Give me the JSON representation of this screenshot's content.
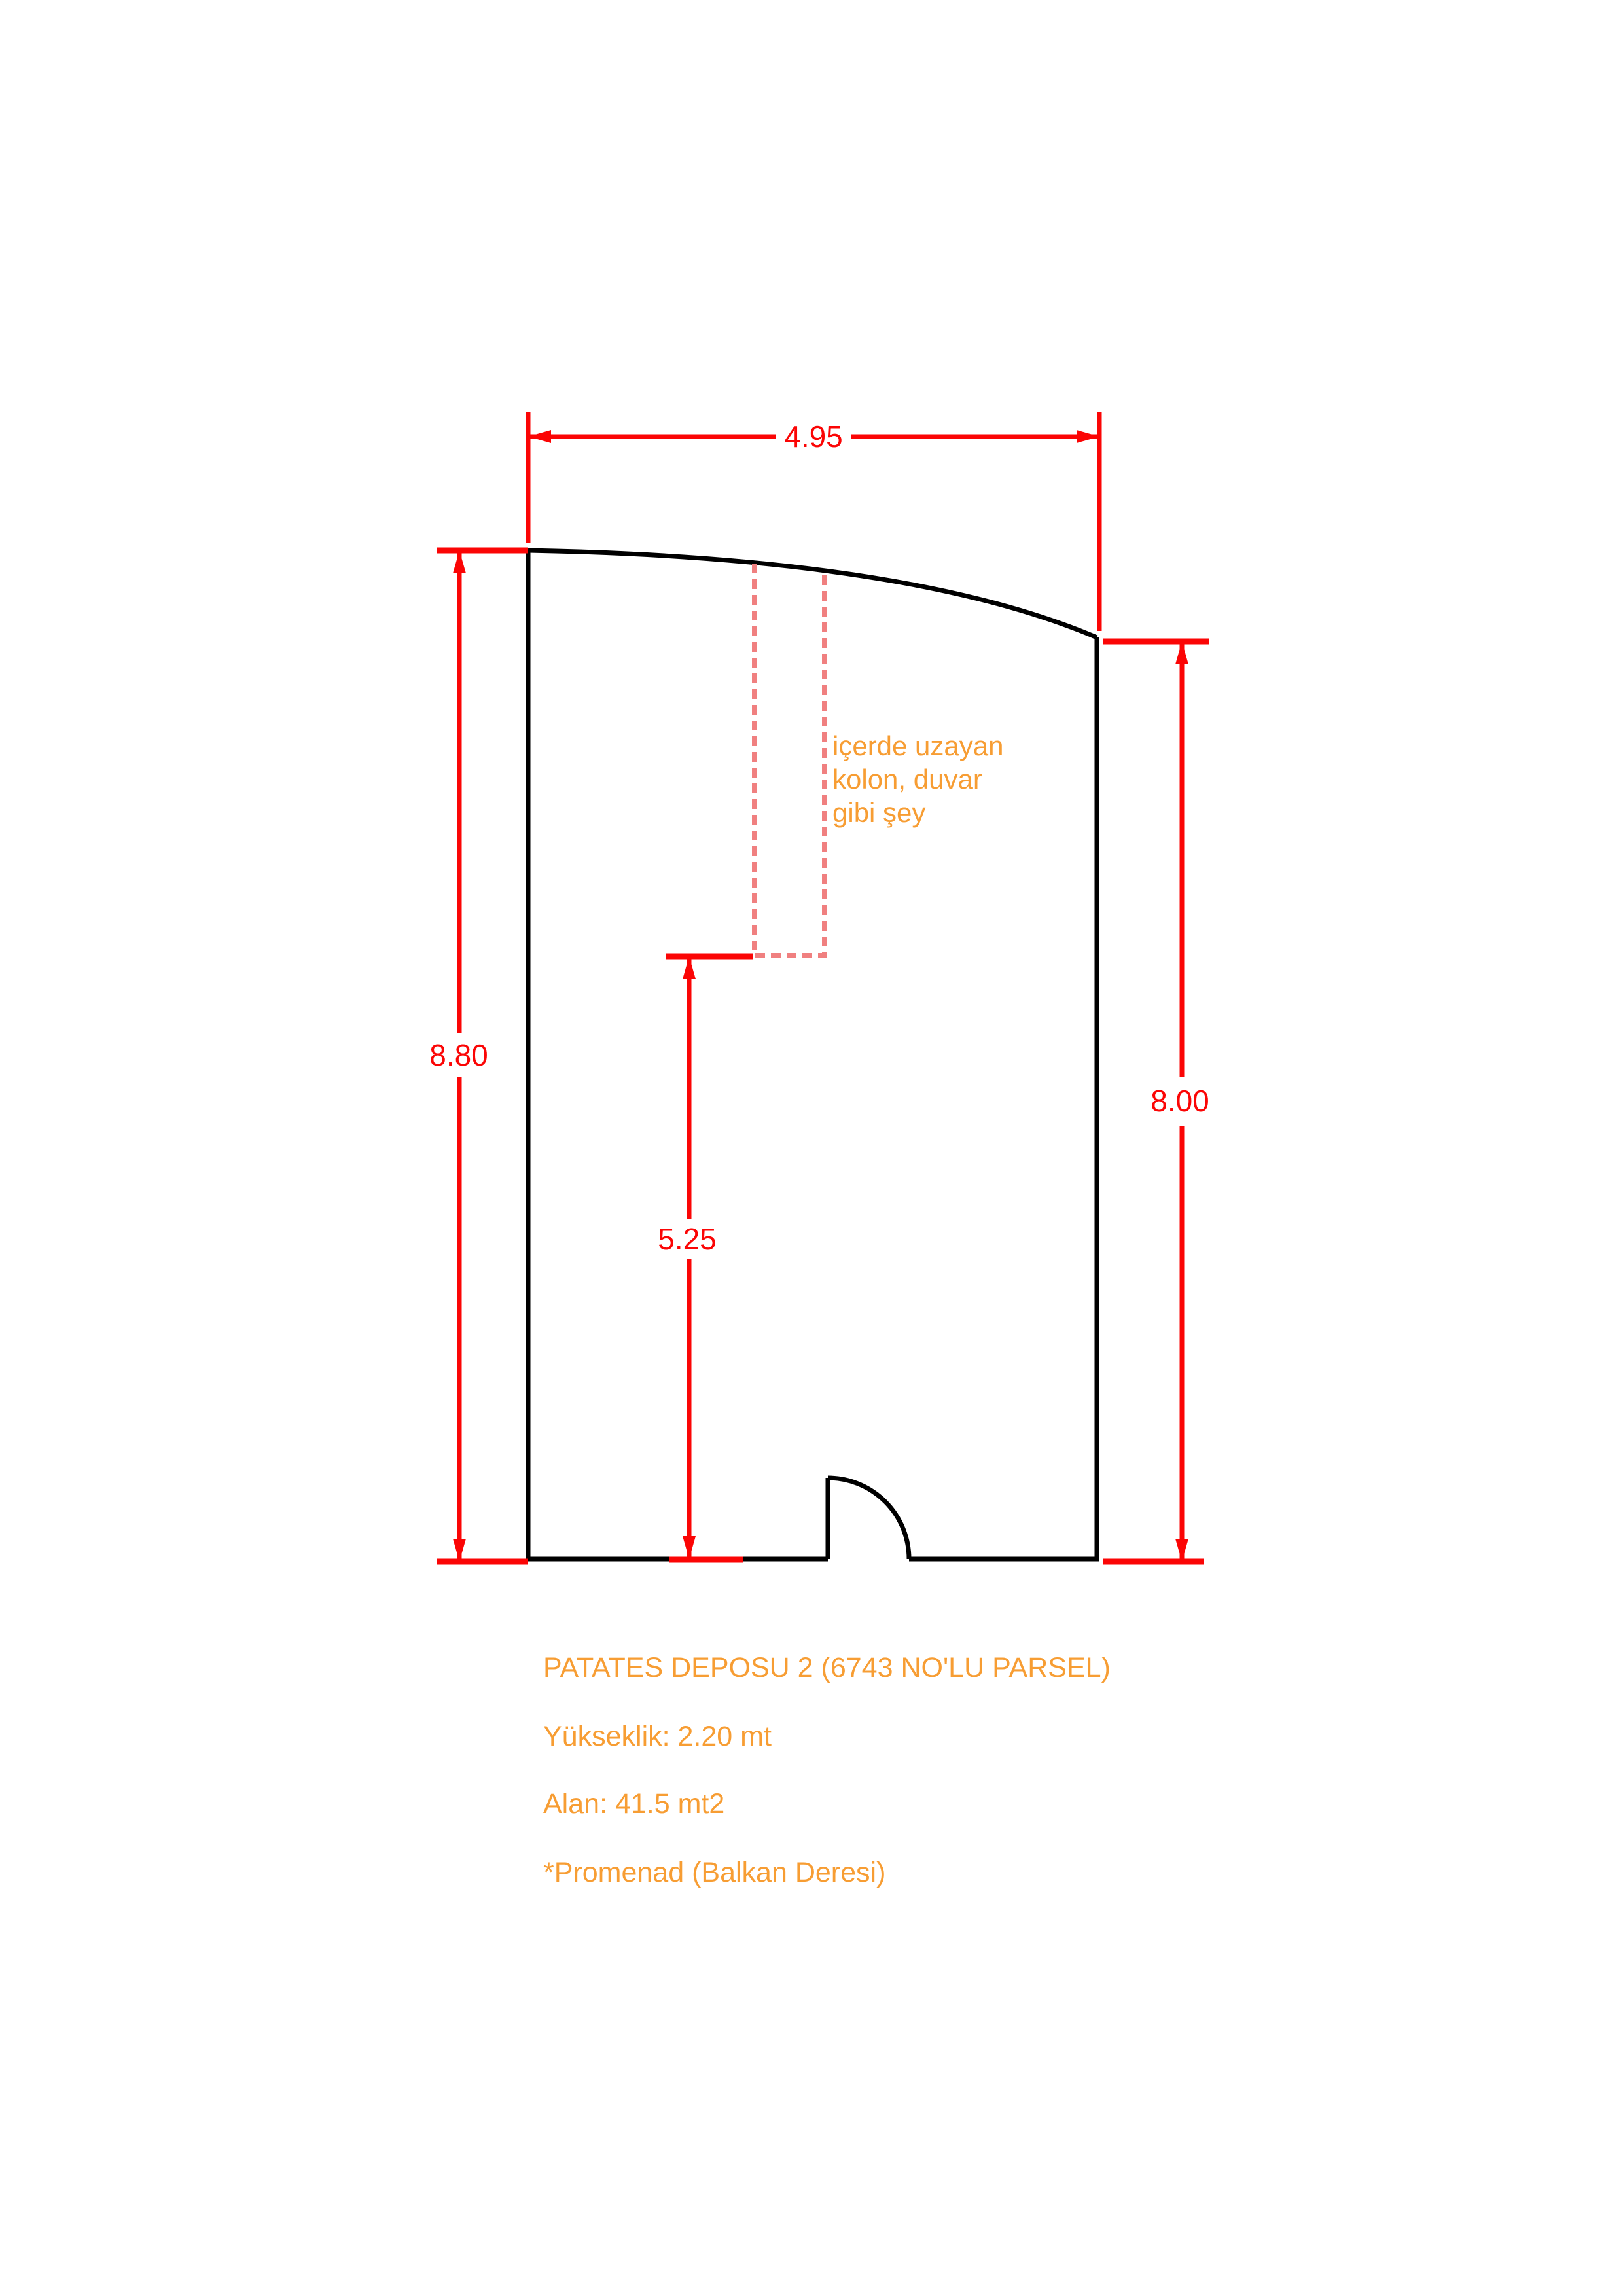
{
  "document": {
    "type": "floor-plan-sketch",
    "background": "#ffffff"
  },
  "colors": {
    "wall-black": "#000000",
    "dimension-red": "#fb0505",
    "column-salmon": "#f08080",
    "note-orange": "#f79d33"
  },
  "dimensions": {
    "top_width": "4.95",
    "left_height": "8.80",
    "right_height": "8.00",
    "interior_height": "5.25"
  },
  "annotation": {
    "line1": "içerde uzayan",
    "line2": "kolon, duvar",
    "line3": "gibi şey"
  },
  "notes": {
    "title": "PATATES DEPOSU 2 (6743 NO'LU PARSEL)",
    "height": "Yükseklik: 2.20 mt",
    "area": "Alan: 41.5 mt2",
    "footnote": "*Promenad (Balkan Deresi)"
  }
}
